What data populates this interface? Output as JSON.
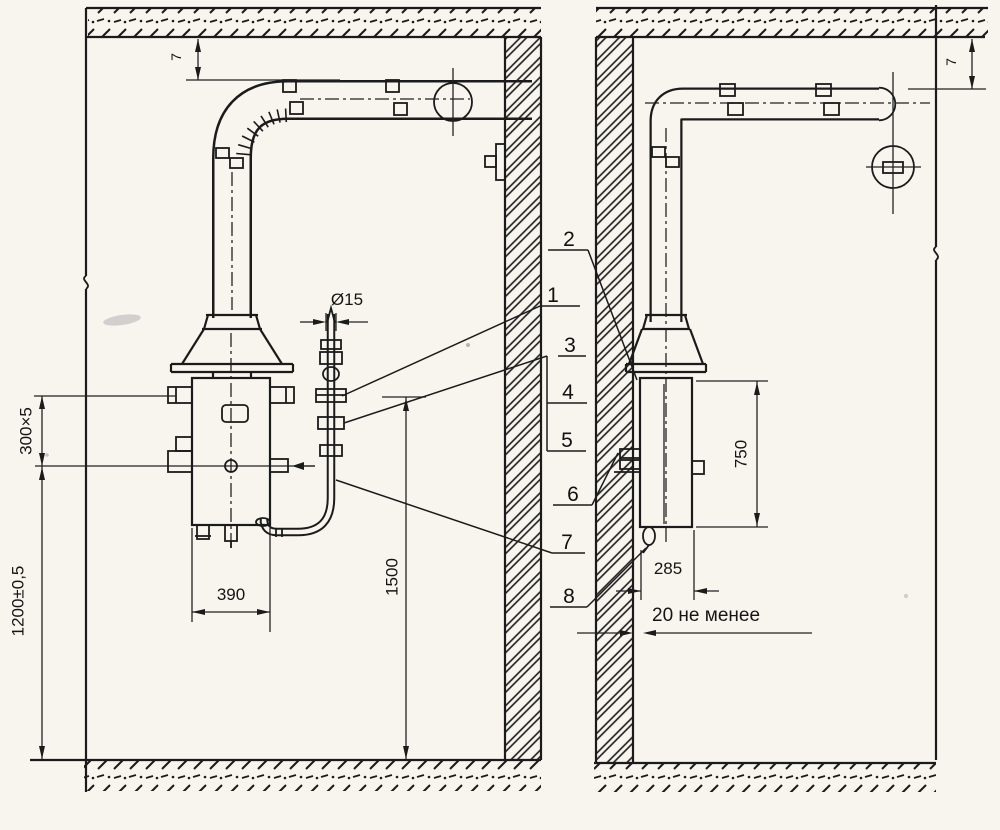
{
  "drawing": {
    "type": "technical-installation-drawing",
    "language": "ru",
    "dimensions": {
      "water_pipe_diameter": "Ø15",
      "mounting_strip": "300×5",
      "mounting_height": "1200±0,5",
      "heater_width": "390",
      "water_connection_height": "1500",
      "heater_height": "750",
      "heater_depth": "285",
      "wall_clearance_min": "20 не менее",
      "ceiling_gap_front_view": "7",
      "ceiling_gap_side_view": "7"
    },
    "callouts": {
      "items": [
        "1",
        "2",
        "3",
        "4",
        "5",
        "6",
        "7",
        "8"
      ]
    }
  }
}
